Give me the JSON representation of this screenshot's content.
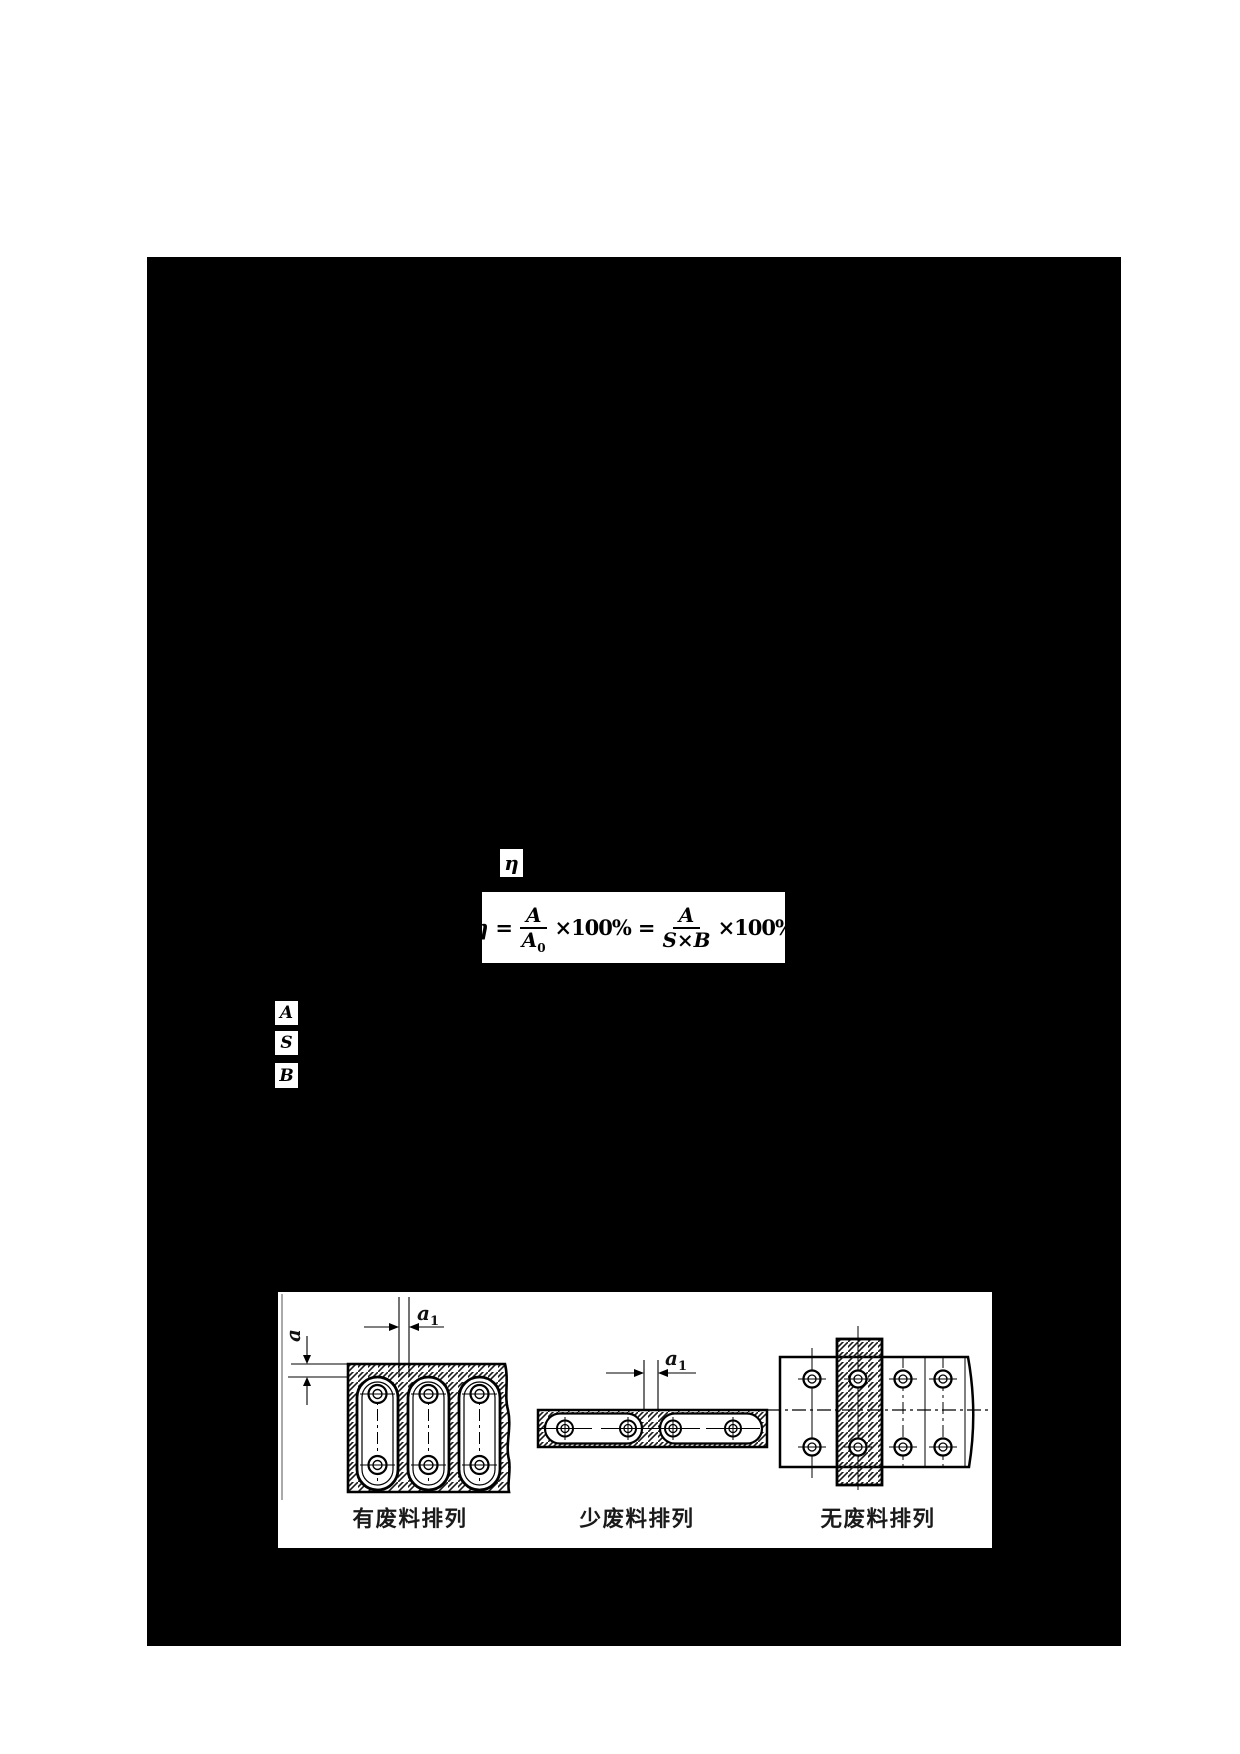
{
  "page": {
    "background": "#ffffff",
    "panel_color": "#000000"
  },
  "eta_box": {
    "symbol": "η"
  },
  "formula": {
    "lhs": "η",
    "equals1": "=",
    "frac1": {
      "num": "A",
      "den_base": "A",
      "den_sub": "0"
    },
    "mult1": "×100%",
    "equals2": "=",
    "frac2": {
      "num": "A",
      "den": "S×B"
    },
    "mult2": "×100%"
  },
  "variable_boxes": [
    {
      "label": "A"
    },
    {
      "label": "S"
    },
    {
      "label": "B"
    }
  ],
  "figure": {
    "captions": [
      {
        "label": "有废料排列"
      },
      {
        "label": "少废料排列"
      },
      {
        "label": "无废料排列"
      }
    ],
    "dimensions": {
      "a": "a",
      "a1_base": "a",
      "a1_sub": "1"
    }
  }
}
